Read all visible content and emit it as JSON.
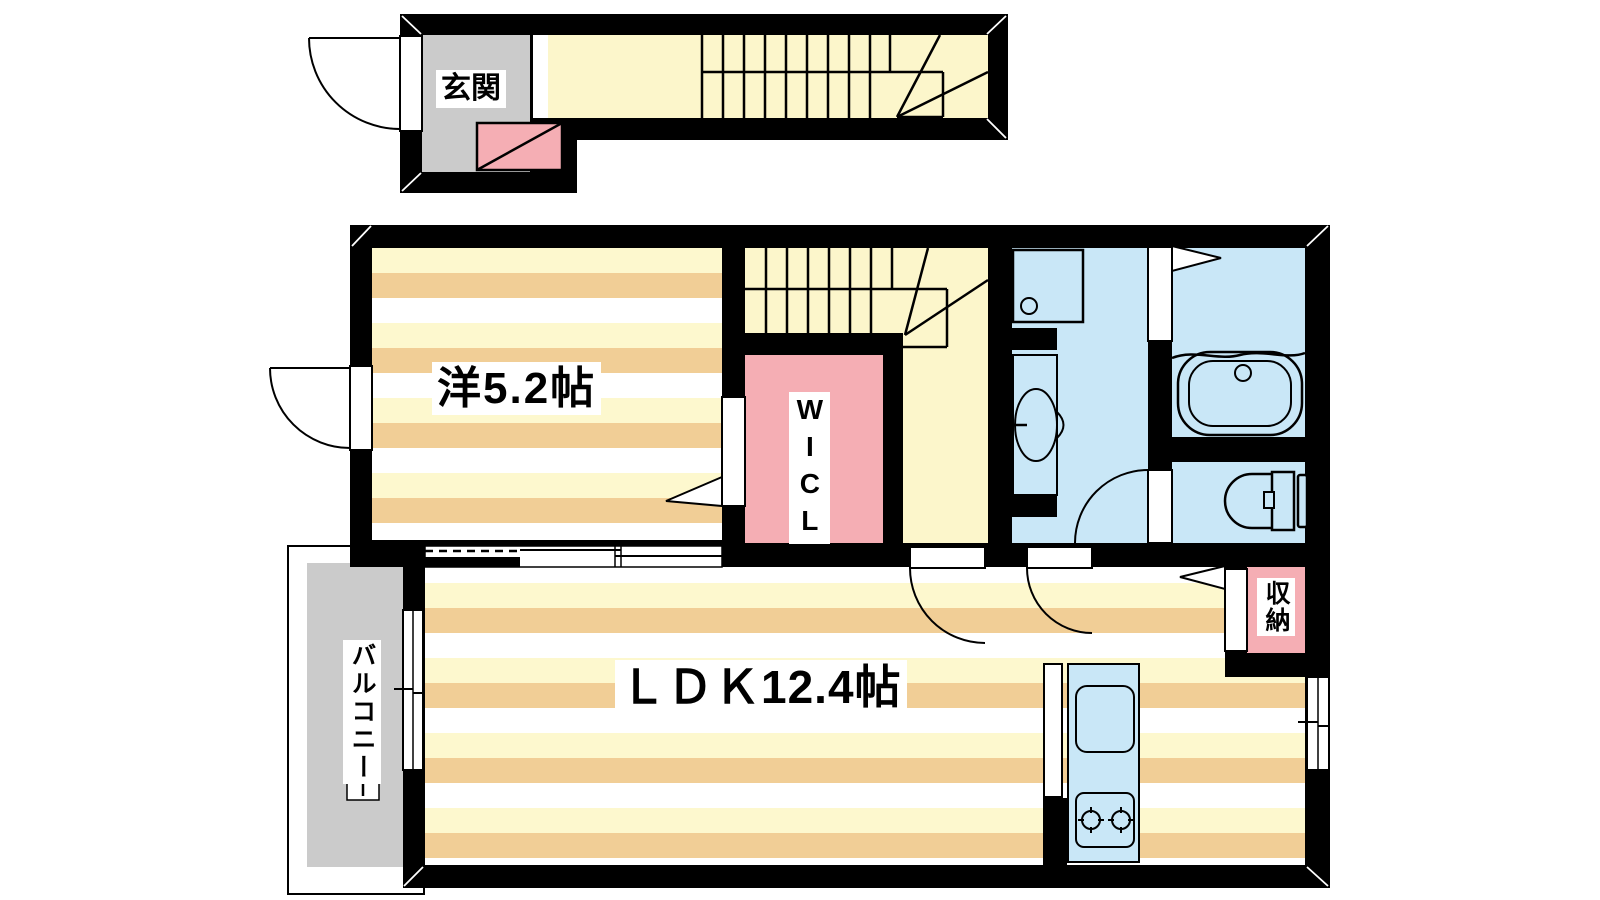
{
  "labels": {
    "entry": "玄関",
    "bedroom": "洋5.2帖",
    "wicl": "WICL",
    "ldk": "ＬＤＫ12.4帖",
    "balcony": "バルコニー",
    "storage": "収納"
  },
  "rooms": [
    {
      "name": "entry",
      "label": "玄関",
      "floor_color": "#CBCBCB"
    },
    {
      "name": "stair-corridor",
      "label": "",
      "floor_color": "#FCF6CB"
    },
    {
      "name": "bedroom",
      "label": "洋5.2帖",
      "floor_color": "striped"
    },
    {
      "name": "wicl",
      "label": "WICL",
      "floor_color": "#F5AEB4"
    },
    {
      "name": "washroom",
      "label": "",
      "floor_color": "#C9E7F7"
    },
    {
      "name": "bathroom",
      "label": "",
      "floor_color": "#C9E7F7"
    },
    {
      "name": "toilet",
      "label": "",
      "floor_color": "#C9E7F7"
    },
    {
      "name": "ldk",
      "label": "ＬＤＫ12.4帖",
      "floor_color": "striped"
    },
    {
      "name": "storage",
      "label": "収納",
      "floor_color": "#F5AEB4"
    },
    {
      "name": "balcony",
      "label": "バルコニー",
      "floor_color": "#CBCBCB"
    }
  ],
  "fixtures": [
    "entrance-door",
    "shoe-cabinet",
    "staircase-1f",
    "staircase-2f",
    "washing-machine-pan",
    "vanity-basin",
    "bathtub",
    "toilet-bowl",
    "kitchen-sink",
    "gas-stove",
    "sliding-door",
    "folding-door",
    "storage-door",
    "balcony-window",
    "ldk-window",
    "bedroom-window"
  ],
  "colors": {
    "wall": "#000000",
    "stripe_cream": "#FDF8CE",
    "stripe_tan": "#F1CE96",
    "hall_yellow": "#FCF6CB",
    "water_blue": "#C9E7F7",
    "closet_pink": "#F5AEB4",
    "concrete_gray": "#CBCBCB"
  }
}
